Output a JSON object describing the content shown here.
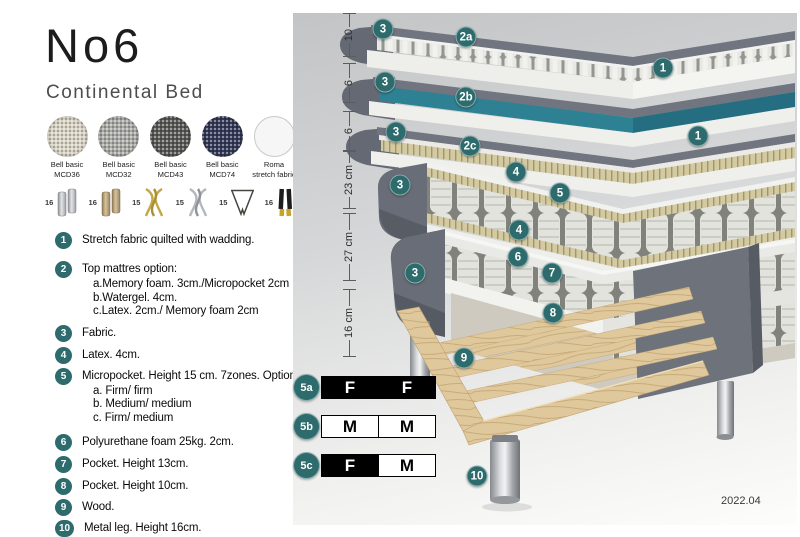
{
  "header": {
    "title": "No6",
    "subtitle": "Continental Bed"
  },
  "swatches": [
    {
      "line1": "Bell basic",
      "line2": "MCD36",
      "color": "#d8d2c4"
    },
    {
      "line1": "Bell basic",
      "line2": "MCD32",
      "color": "#a9a9a6"
    },
    {
      "line1": "Bell basic",
      "line2": "MCD43",
      "color": "#595a57"
    },
    {
      "line1": "Bell basic",
      "line2": "MCD74",
      "color": "#353a58"
    },
    {
      "line1": "Roma",
      "line2": "stretch fabric",
      "color": "#f6f6f6"
    }
  ],
  "leg_options": [
    {
      "size": "16",
      "type": "cylinder-silver"
    },
    {
      "size": "16",
      "type": "cylinder-wood"
    },
    {
      "size": "15",
      "type": "twisted-gold"
    },
    {
      "size": "15",
      "type": "twisted-silver"
    },
    {
      "size": "15",
      "type": "hairpin"
    },
    {
      "size": "16",
      "type": "straight-black-gold"
    }
  ],
  "features": [
    {
      "num": "1",
      "text": "Stretch fabric quilted with wadding."
    },
    {
      "num": "2",
      "text": "Top mattres option:",
      "sub": [
        "a.Memory foam. 3cm./Micropocket 2cm",
        "b.Watergel. 4cm.",
        "c.Latex. 2cm./ Memory foam 2cm"
      ]
    },
    {
      "num": "3",
      "text": "Fabric."
    },
    {
      "num": "4",
      "text": "Latex. 4cm."
    },
    {
      "num": "5",
      "text": "Micropocket. Height 15 cm. 7zones. Option:",
      "sub": [
        "a. Firm/ firm",
        "b. Medium/ medium",
        "c. Firm/ medium"
      ]
    },
    {
      "num": "6",
      "text": "Polyurethane foam 25kg. 2cm."
    },
    {
      "num": "7",
      "text": "Pocket. Height 13cm."
    },
    {
      "num": "8",
      "text": "Pocket. Height 10cm."
    },
    {
      "num": "9",
      "text": "Wood."
    },
    {
      "num": "10",
      "text": "Metal leg. Height 16cm."
    }
  ],
  "measurements": [
    "10",
    "6",
    "6",
    "23 cm",
    "27 cm",
    "16 cm"
  ],
  "callouts": [
    "3",
    "2a",
    "1",
    "3",
    "2b",
    "1",
    "3",
    "2c",
    "4",
    "3",
    "5",
    "4",
    "6",
    "3",
    "7",
    "8",
    "9",
    "10"
  ],
  "firmness": {
    "rows": [
      {
        "id": "5a",
        "left": "F",
        "right": "F",
        "left_style": "dark",
        "right_style": "dark"
      },
      {
        "id": "5b",
        "left": "M",
        "right": "M",
        "left_style": "light",
        "right_style": "light"
      },
      {
        "id": "5c",
        "left": "F",
        "right": "M",
        "left_style": "dark",
        "right_style": "light"
      }
    ]
  },
  "footer": {
    "version": "2022.04"
  },
  "colors": {
    "accent_teal": "#2d6b6d",
    "watergel_teal": "#2e8093",
    "cover_gray": "#70757f",
    "latex_tan": "#d3caa2",
    "wood": "#dfc79c",
    "firm_cell_dark": "#000000",
    "firm_cell_light": "#ffffff"
  }
}
